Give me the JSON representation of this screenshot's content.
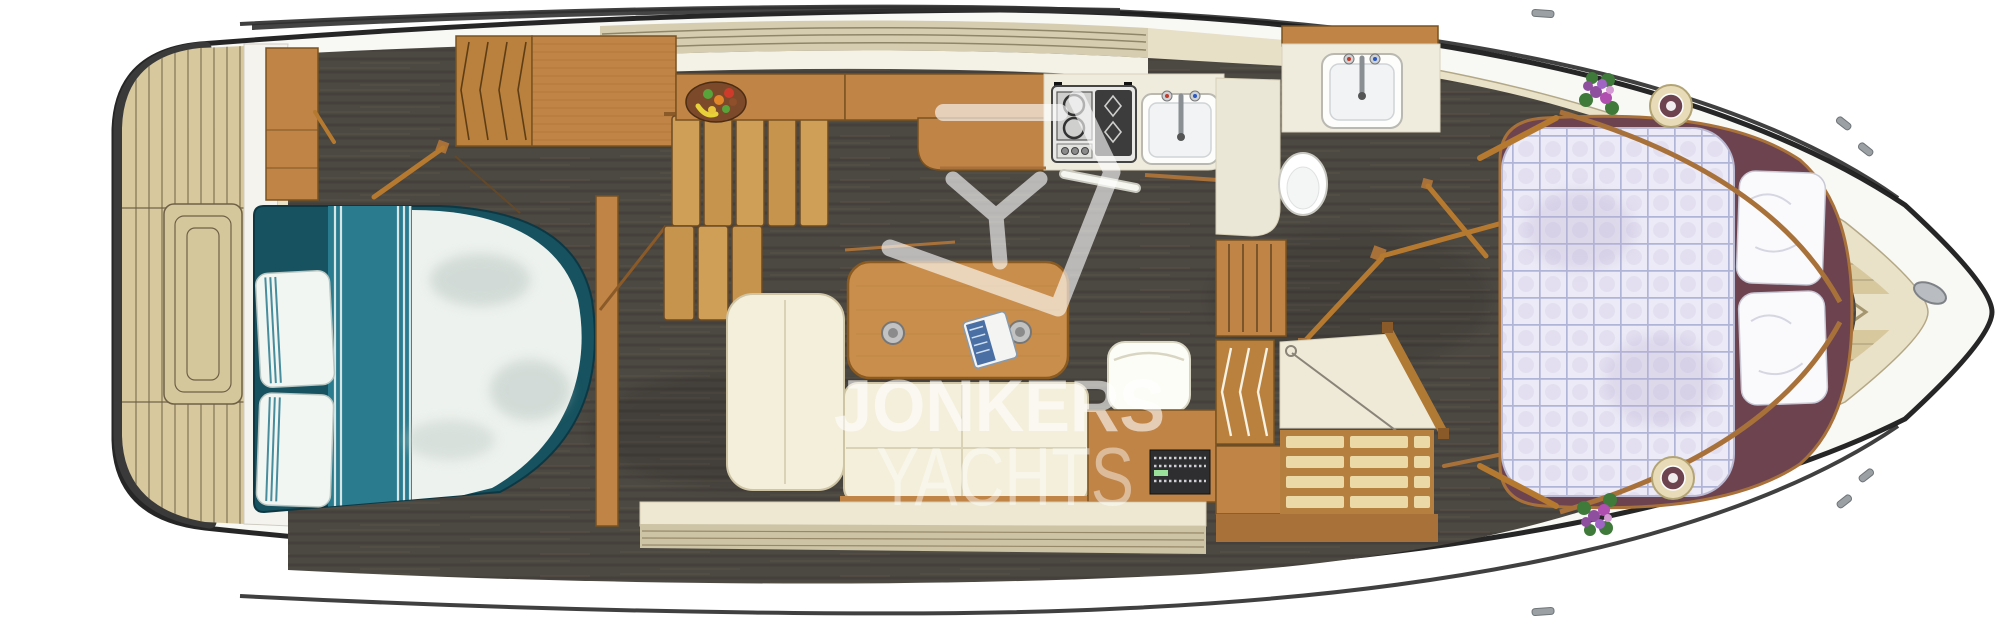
{
  "watermark": {
    "line1": "JONKERS",
    "line2": "YACHTS",
    "logo": "jonkers-shield-y-logo"
  },
  "palette": {
    "hull_white": "#f8f8f5",
    "outline": "#262626",
    "deck_cream": "#e9e1c8",
    "teak": "#d7c89e",
    "teak_line": "#8d7e5c",
    "wood": "#c08447",
    "wood_dark": "#7a5220",
    "floor_dark": "#4c4842",
    "sofa_cream": "#f3efdb",
    "counter_cream": "#efecdd",
    "teal": "#2a7b8e",
    "teal_deep": "#16525f",
    "duvet_white": "#edf2ee",
    "quilt_lavender": "#eceaf6",
    "quilt_line": "#a6abd1",
    "plum": "#6d4350",
    "flower_purple": "#8e4f9e",
    "leaf_green": "#3f7a3a",
    "watermark": "#ffffff"
  }
}
